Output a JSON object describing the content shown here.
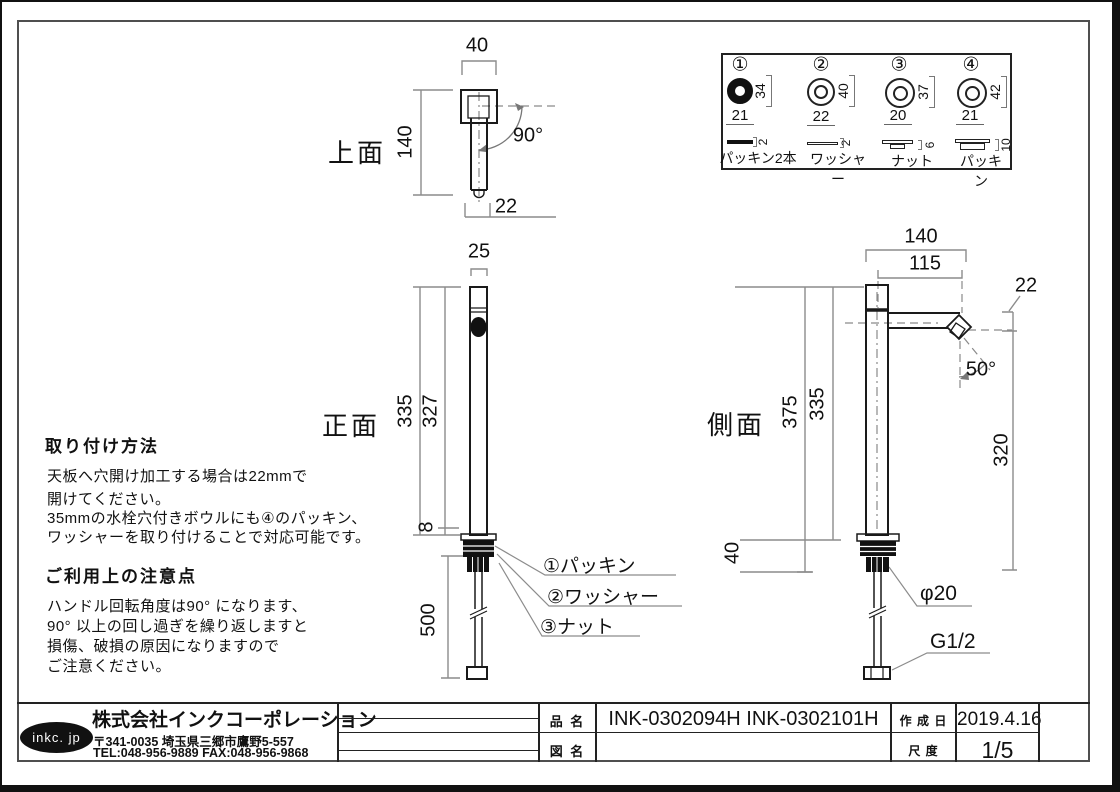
{
  "views": {
    "top": {
      "label": "上面",
      "dim_width": "40",
      "dim_height": "140",
      "dim_tip": "22",
      "angle": "90°"
    },
    "front": {
      "label": "正面",
      "dim_width": "25",
      "dim_total": "335",
      "dim_body": "327",
      "dim_flange": "8",
      "dim_hose": "500",
      "callout_packing": "①パッキン",
      "callout_washer": "②ワッシャー",
      "callout_nut": "③ナット"
    },
    "side": {
      "label": "側面",
      "dim_reach": "140",
      "dim_spout": "115",
      "dim_tip": "22",
      "angle": "50°",
      "dim_total": "375",
      "dim_body": "335",
      "dim_under": "40",
      "dim_clear": "320",
      "dim_dia": "φ20",
      "dim_thread": "G1/2"
    }
  },
  "legend": {
    "items": [
      {
        "num": "①",
        "od": "34",
        "id": "21",
        "t": "2",
        "name": "パッキン2本"
      },
      {
        "num": "②",
        "od": "40",
        "id": "22",
        "t": "2",
        "name": "ワッシャー"
      },
      {
        "num": "③",
        "od": "37",
        "id": "20",
        "t": "6",
        "name": "ナット"
      },
      {
        "num": "④",
        "od": "42",
        "id": "21",
        "t": "10",
        "name": "パッキン"
      }
    ]
  },
  "notes": {
    "install_title": "取り付け方法",
    "install_lines": [
      "天板へ穴開け加工する場合は22mmで",
      "開けてください。",
      "35mmの水栓穴付きボウルにも④のパッキン、",
      "ワッシャーを取り付けることで対応可能です。"
    ],
    "caution_title": "ご利用上の注意点",
    "caution_lines": [
      "ハンドル回転角度は90° になります、",
      "90° 以上の回し過ぎを繰り返しますと",
      "損傷、破損の原因になりますので",
      "ご注意ください。"
    ]
  },
  "title_block": {
    "logo": "inkc. jp",
    "company": "株式会社インクコーポレーション",
    "address": "〒341-0035 埼玉県三郷市鷹野5-557",
    "tel_fax": "TEL:048-956-9889  FAX:048-956-9868",
    "part_label": "品 名",
    "part_value": "INK-0302094H  INK-0302101H",
    "drawing_label": "図 名",
    "drawing_value": "",
    "date_label": "作 成 日",
    "date_value": "2019.4.16",
    "scale_label": "尺 度",
    "scale_value": "1/5"
  }
}
